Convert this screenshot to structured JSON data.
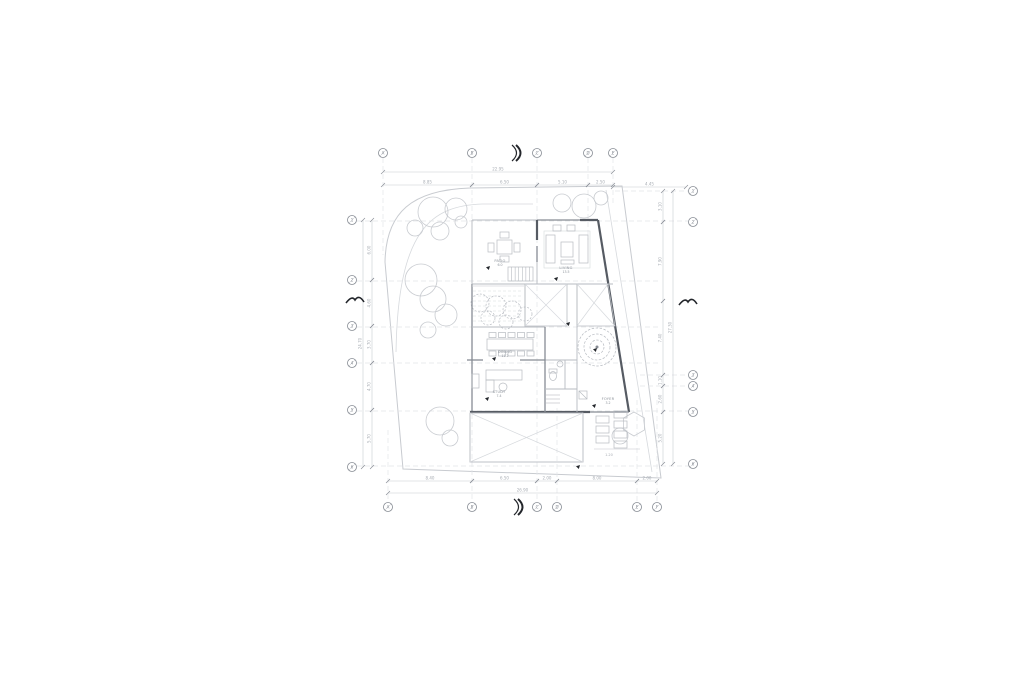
{
  "drawing": {
    "type": "architectural-floor-plan",
    "sheet": {
      "width": 1024,
      "height": 682,
      "background": "#ffffff"
    }
  },
  "palette": {
    "bg": "#ffffff",
    "grid": "#e3e5e8",
    "site": "#c8cbd0",
    "faint": "#d6d9dd",
    "light": "#b7bbc1",
    "med": "#878c94",
    "wall": "#565b63",
    "dark": "#23262b",
    "text": "#a8adb4",
    "label": "#8d939b"
  },
  "site": {
    "outline": "M 470,188 C 412,190 386,212 385,262 L 403,469 L 661,478 L 622,186 Z",
    "inner_curve": "M 533,204 L 482,204 C 432,206 398,228 396,352",
    "extra_slant": "M 606,190 L 652,472"
  },
  "grid": {
    "vlines": [
      [
        383,
        158,
        255
      ],
      [
        472,
        158,
        502
      ],
      [
        537,
        158,
        502
      ],
      [
        588,
        158,
        240
      ],
      [
        613,
        158,
        205
      ],
      [
        557,
        408,
        502
      ],
      [
        637,
        400,
        502
      ],
      [
        657,
        400,
        502
      ],
      [
        388,
        430,
        502
      ]
    ],
    "hlines": [
      [
        191,
        615,
        688
      ],
      [
        221,
        357,
        688
      ],
      [
        281,
        357,
        660
      ],
      [
        327,
        357,
        660
      ],
      [
        363,
        357,
        660
      ],
      [
        375,
        640,
        688
      ],
      [
        386,
        640,
        688
      ],
      [
        411,
        357,
        688
      ],
      [
        466,
        357,
        688
      ]
    ],
    "bubbles": [
      {
        "x": 383,
        "y": 153,
        "label": "A"
      },
      {
        "x": 472,
        "y": 153,
        "label": "B"
      },
      {
        "x": 537,
        "y": 153,
        "label": "C"
      },
      {
        "x": 588,
        "y": 153,
        "label": "D"
      },
      {
        "x": 613,
        "y": 153,
        "label": "E"
      },
      {
        "x": 388,
        "y": 507,
        "label": "A"
      },
      {
        "x": 472,
        "y": 507,
        "label": "B"
      },
      {
        "x": 537,
        "y": 507,
        "label": "C"
      },
      {
        "x": 557,
        "y": 507,
        "label": "D"
      },
      {
        "x": 637,
        "y": 507,
        "label": "E"
      },
      {
        "x": 657,
        "y": 507,
        "label": "F"
      },
      {
        "x": 352,
        "y": 220,
        "label": "1"
      },
      {
        "x": 352,
        "y": 280,
        "label": "2"
      },
      {
        "x": 352,
        "y": 326,
        "label": "3"
      },
      {
        "x": 352,
        "y": 363,
        "label": "4"
      },
      {
        "x": 352,
        "y": 410,
        "label": "5"
      },
      {
        "x": 352,
        "y": 467,
        "label": "6"
      },
      {
        "x": 693,
        "y": 191,
        "label": "1"
      },
      {
        "x": 693,
        "y": 222,
        "label": "2"
      },
      {
        "x": 693,
        "y": 375,
        "label": "3"
      },
      {
        "x": 693,
        "y": 386,
        "label": "4"
      },
      {
        "x": 693,
        "y": 412,
        "label": "5"
      },
      {
        "x": 693,
        "y": 464,
        "label": "6"
      }
    ]
  },
  "walls": [
    [
      472,
      220,
      537,
      220,
      "light"
    ],
    [
      537,
      220,
      580,
      220,
      "med"
    ],
    [
      580,
      220,
      598,
      220,
      "dark"
    ],
    [
      537,
      220,
      537,
      240,
      "dark"
    ],
    [
      537,
      246,
      537,
      262,
      "med"
    ],
    [
      537,
      262,
      537,
      284,
      "light"
    ],
    [
      598,
      220,
      629,
      412,
      "dark"
    ],
    [
      472,
      220,
      472,
      284,
      "light"
    ],
    [
      472,
      284,
      472,
      412,
      "med"
    ],
    [
      470,
      412,
      590,
      412,
      "dark"
    ],
    [
      590,
      412,
      629,
      412,
      "med"
    ],
    [
      472,
      284,
      537,
      284,
      "light"
    ],
    [
      537,
      284,
      613,
      284,
      "light"
    ],
    [
      472,
      327,
      545,
      327,
      "light"
    ],
    [
      577,
      284,
      577,
      412,
      "light"
    ],
    [
      467,
      360,
      483,
      360,
      "med"
    ],
    [
      520,
      360,
      545,
      360,
      "med"
    ],
    [
      545,
      360,
      577,
      360,
      "light"
    ],
    [
      545,
      327,
      545,
      412,
      "med"
    ],
    [
      545,
      389,
      577,
      389,
      "light"
    ],
    [
      565,
      360,
      565,
      389,
      "light"
    ],
    [
      525,
      284,
      525,
      327,
      "light"
    ],
    [
      472,
      286,
      524,
      286,
      "faint"
    ],
    [
      594,
      449,
      640,
      449,
      "faint"
    ]
  ],
  "voids": [
    {
      "pts": [
        [
          525,
          284
        ],
        [
          567,
          284
        ],
        [
          567,
          326
        ],
        [
          525,
          326
        ]
      ]
    },
    {
      "pts": [
        [
          577,
          284
        ],
        [
          608,
          284
        ],
        [
          615,
          326
        ],
        [
          577,
          326
        ]
      ]
    }
  ],
  "deck": {
    "x": 470,
    "y": 413,
    "w": 113,
    "h": 49
  },
  "stairs": {
    "x": 508,
    "y": 267,
    "w": 25,
    "h": 14,
    "treads": 7
  },
  "planter": {
    "x": 473,
    "y": 289,
    "w": 50,
    "rows": [
      291,
      296,
      301,
      306,
      311,
      316,
      321
    ]
  },
  "shrubs": [
    [
      480,
      303,
      9
    ],
    [
      496,
      306,
      10
    ],
    [
      512,
      310,
      9
    ],
    [
      525,
      314,
      7
    ],
    [
      488,
      318,
      7
    ],
    [
      506,
      322,
      7
    ]
  ],
  "trees": [
    [
      433,
      212,
      15
    ],
    [
      456,
      209,
      11
    ],
    [
      415,
      228,
      8
    ],
    [
      440,
      231,
      9
    ],
    [
      461,
      222,
      6
    ],
    [
      421,
      280,
      16
    ],
    [
      433,
      299,
      13
    ],
    [
      446,
      315,
      11
    ],
    [
      428,
      330,
      8
    ],
    [
      562,
      203,
      9
    ],
    [
      584,
      206,
      12
    ],
    [
      601,
      198,
      7
    ],
    [
      440,
      421,
      14
    ],
    [
      450,
      438,
      8
    ],
    [
      620,
      436,
      8
    ]
  ],
  "hex_tree": {
    "x": 634,
    "y": 424,
    "r": 12
  },
  "ring_tree": {
    "x": 597,
    "y": 347,
    "radii": [
      19,
      13,
      7
    ],
    "dot": 1.5
  },
  "furniture": {
    "rects": [
      [
        497,
        240,
        15,
        14
      ],
      [
        500,
        232,
        9,
        6
      ],
      [
        500,
        256,
        9,
        6
      ],
      [
        488,
        243,
        6,
        9
      ],
      [
        514,
        243,
        6,
        9
      ],
      [
        546,
        235,
        9,
        28
      ],
      [
        579,
        235,
        9,
        28
      ],
      [
        561,
        242,
        12,
        15
      ],
      [
        553,
        225,
        8,
        6
      ],
      [
        567,
        225,
        8,
        6
      ],
      [
        561,
        260,
        13,
        4
      ],
      [
        487,
        339,
        46,
        11
      ],
      [
        489,
        332.5,
        7,
        5
      ],
      [
        498.5,
        332.5,
        7,
        5
      ],
      [
        508,
        332.5,
        7,
        5
      ],
      [
        517.5,
        332.5,
        7,
        5
      ],
      [
        527,
        332.5,
        7,
        5
      ],
      [
        489,
        351,
        7,
        5
      ],
      [
        498.5,
        351,
        7,
        5
      ],
      [
        508,
        351,
        7,
        5
      ],
      [
        517.5,
        351,
        7,
        5
      ],
      [
        527,
        351,
        7,
        5
      ],
      [
        486,
        370,
        36,
        10
      ],
      [
        486,
        380,
        8,
        12
      ],
      [
        472,
        374,
        7,
        14
      ],
      [
        549,
        369,
        8,
        4
      ],
      [
        579,
        391,
        8,
        8
      ],
      [
        596,
        416,
        13,
        7
      ],
      [
        596,
        426,
        13,
        7
      ],
      [
        596,
        436,
        13,
        7
      ],
      [
        614,
        411,
        13,
        7
      ],
      [
        614,
        421,
        13,
        7
      ],
      [
        614,
        431,
        13,
        7
      ],
      [
        614,
        441,
        13,
        7
      ]
    ],
    "rug": [
      544,
      231,
      46,
      37
    ],
    "circles": [
      [
        503,
        387,
        4
      ],
      [
        560,
        364,
        3
      ]
    ],
    "toilet": {
      "cx": 553,
      "cy": 376,
      "rx": 3.5,
      "ry": 4.5
    },
    "lines": [
      [
        546,
        395,
        560,
        395
      ],
      [
        546,
        399,
        560,
        399
      ],
      [
        546,
        403,
        560,
        403
      ],
      [
        579,
        391,
        587,
        399
      ]
    ]
  },
  "dimensions": {
    "horizontal": [
      {
        "x1": 383,
        "x2": 613,
        "y": 172,
        "t": "22.95"
      },
      {
        "x1": 383,
        "x2": 472,
        "y": 185,
        "t": "8.85"
      },
      {
        "x1": 472,
        "x2": 537,
        "y": 185,
        "t": "6.50"
      },
      {
        "x1": 537,
        "x2": 588,
        "y": 185,
        "t": "5.10"
      },
      {
        "x1": 588,
        "x2": 613,
        "y": 185,
        "t": "2.50"
      },
      {
        "x1": 613,
        "x2": 686,
        "y": 187,
        "t": "4.45"
      },
      {
        "x1": 388,
        "x2": 472,
        "y": 481,
        "t": "8.40"
      },
      {
        "x1": 472,
        "x2": 537,
        "y": 481,
        "t": "6.50"
      },
      {
        "x1": 537,
        "x2": 557,
        "y": 481,
        "t": "2.00"
      },
      {
        "x1": 557,
        "x2": 637,
        "y": 481,
        "t": "8.00"
      },
      {
        "x1": 637,
        "x2": 657,
        "y": 481,
        "t": "2.00"
      },
      {
        "x1": 388,
        "x2": 657,
        "y": 493,
        "t": "26.90"
      }
    ],
    "vertical": [
      {
        "x": 372,
        "y1": 220,
        "y2": 280,
        "t": "6.00"
      },
      {
        "x": 372,
        "y1": 280,
        "y2": 326,
        "t": "4.60"
      },
      {
        "x": 372,
        "y1": 326,
        "y2": 363,
        "t": "3.70"
      },
      {
        "x": 372,
        "y1": 363,
        "y2": 410,
        "t": "4.70"
      },
      {
        "x": 372,
        "y1": 410,
        "y2": 467,
        "t": "5.70"
      },
      {
        "x": 363,
        "y1": 220,
        "y2": 467,
        "t": "24.70"
      },
      {
        "x": 663,
        "y1": 191,
        "y2": 222,
        "t": "3.10"
      },
      {
        "x": 663,
        "y1": 222,
        "y2": 301,
        "t": "7.90"
      },
      {
        "x": 663,
        "y1": 301,
        "y2": 375,
        "t": "7.40"
      },
      {
        "x": 663,
        "y1": 375,
        "y2": 386,
        "t": "1.10"
      },
      {
        "x": 663,
        "y1": 386,
        "y2": 412,
        "t": "2.60"
      },
      {
        "x": 663,
        "y1": 412,
        "y2": 464,
        "t": "5.20"
      },
      {
        "x": 673,
        "y1": 191,
        "y2": 464,
        "t": "27.30"
      }
    ],
    "mini": [
      {
        "x": 609,
        "y": 456,
        "t": "1.20"
      }
    ]
  },
  "labels": [
    {
      "x": 500,
      "y": 262,
      "name": "PATIO",
      "area": "6.0",
      "dx": 490,
      "dy": 266
    },
    {
      "x": 566,
      "y": 269,
      "name": "LIVING",
      "area": "13.5",
      "dx": 558,
      "dy": 277
    },
    {
      "x": 505,
      "y": 353,
      "name": "DINING",
      "area": "11.2",
      "dx": 496,
      "dy": 357
    },
    {
      "x": 499,
      "y": 393,
      "name": "STUDY",
      "area": "7.4",
      "dx": 489,
      "dy": 397
    },
    {
      "x": 608,
      "y": 400,
      "name": "FOYER",
      "area": "3.2",
      "dx": 596,
      "dy": 404
    }
  ],
  "leader_dots": [
    [
      570,
      322
    ],
    [
      597,
      348
    ],
    [
      580,
      465
    ]
  ],
  "section_chevrons": [
    [
      521,
      153
    ],
    [
      523,
      507
    ]
  ],
  "roof_marks": [
    [
      355,
      300
    ],
    [
      688,
      302
    ]
  ]
}
